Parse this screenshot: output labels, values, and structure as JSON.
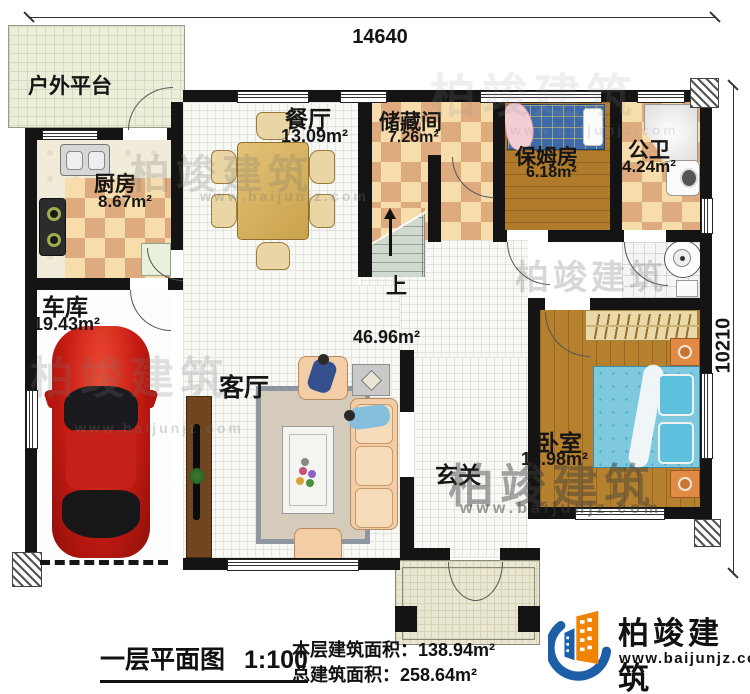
{
  "dimensions": {
    "top": "14640",
    "right": "10210"
  },
  "rooms": {
    "platform": {
      "label": "户外平台"
    },
    "kitchen": {
      "label": "厨房",
      "area": "8.67m²"
    },
    "dining": {
      "label": "餐厅",
      "area": "13.09m²"
    },
    "storage": {
      "label": "储藏间",
      "area": "7.26m²"
    },
    "nanny": {
      "label": "保姆房",
      "area": "6.18m²"
    },
    "bath": {
      "label": "公卫",
      "area": "4.24m²"
    },
    "garage": {
      "label": "车库",
      "area": "19.43m²"
    },
    "living": {
      "label": "客厅",
      "area": "46.96m²"
    },
    "foyer": {
      "label": "玄关"
    },
    "bedroom": {
      "label": "卧室",
      "area": "13.98m²"
    }
  },
  "stairs": {
    "up_label": "上"
  },
  "footer": {
    "plan_title": "一层平面图",
    "scale": "1:100",
    "floor_area_label": "本层建筑面积：",
    "floor_area_value": "138.94m²",
    "total_area_label": "总建筑面积：",
    "total_area_value": "258.64m²"
  },
  "brand": {
    "name": "柏竣建筑",
    "website": "www.baijunjz.com"
  },
  "colors": {
    "wall": "#141414",
    "checker_light": "#f6ddab",
    "checker_dark": "#ddab7e",
    "wood": "#b5812f",
    "bed_blue": "#7fc9de",
    "nanny_bed_blue": "#3e6aaa",
    "car_red": "#c61f1f",
    "sofa_peach": "#f0c49e",
    "logo_blue": "#1c5fa8",
    "logo_orange": "#f08300"
  }
}
